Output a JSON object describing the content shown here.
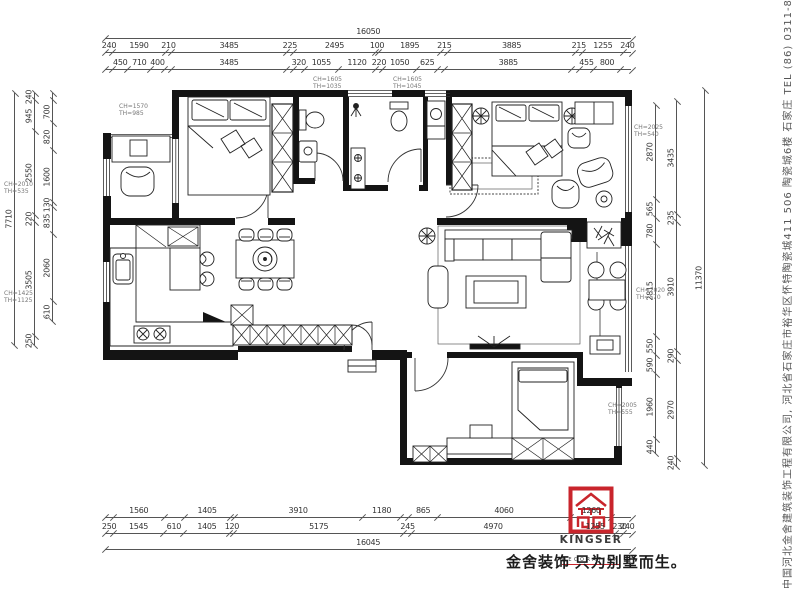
{
  "company_info": "中国河北金舍建筑装饰工程有限公司, 河北省石家庄市裕华区怀特陶瓷城411 506 陶瓷城6楼  石家庄  TEL (86) 0311-88995555",
  "slogan": "金舍装饰 只为别墅而生。",
  "logo": {
    "name": "KINGSER",
    "subtitle": "DECORATION",
    "accent_color": "#c9252c"
  },
  "dimensions": {
    "top_total": [
      {
        "v": 16050,
        "l": "16050"
      }
    ],
    "top_row2": [
      {
        "v": 240,
        "l": "240"
      },
      {
        "v": 1590,
        "l": "1590"
      },
      {
        "v": 210,
        "l": "210"
      },
      {
        "v": 3485,
        "l": "3485"
      },
      {
        "v": 225,
        "l": "225"
      },
      {
        "v": 2495,
        "l": "2495"
      },
      {
        "v": 100,
        "l": "100"
      },
      {
        "v": 1895,
        "l": "1895"
      },
      {
        "v": 215,
        "l": "215"
      },
      {
        "v": 3885,
        "l": "3885"
      },
      {
        "v": 215,
        "l": "215"
      },
      {
        "v": 1255,
        "l": "1255"
      },
      {
        "v": 240,
        "l": "240"
      }
    ],
    "top_row3": [
      {
        "v": 240,
        "l": ""
      },
      {
        "v": 450,
        "l": "450"
      },
      {
        "v": 710,
        "l": "710"
      },
      {
        "v": 400,
        "l": "400"
      },
      {
        "v": 240,
        "l": ""
      },
      {
        "v": 3485,
        "l": "3485"
      },
      {
        "v": 225,
        "l": ""
      },
      {
        "v": 320,
        "l": "320"
      },
      {
        "v": 1055,
        "l": "1055"
      },
      {
        "v": 1120,
        "l": "1120"
      },
      {
        "v": 220,
        "l": "220"
      },
      {
        "v": 1050,
        "l": "1050"
      },
      {
        "v": 625,
        "l": "625"
      },
      {
        "v": 215,
        "l": ""
      },
      {
        "v": 3885,
        "l": "3885"
      },
      {
        "v": 215,
        "l": ""
      },
      {
        "v": 455,
        "l": "455"
      },
      {
        "v": 800,
        "l": "800"
      },
      {
        "v": 340,
        "l": ""
      }
    ],
    "bottom_row1": [
      {
        "v": 250,
        "l": ""
      },
      {
        "v": 1560,
        "l": "1560"
      },
      {
        "v": 600,
        "l": ""
      },
      {
        "v": 1405,
        "l": "1405"
      },
      {
        "v": 120,
        "l": ""
      },
      {
        "v": 3910,
        "l": "3910"
      },
      {
        "v": 1180,
        "l": "1180"
      },
      {
        "v": 245,
        "l": ""
      },
      {
        "v": 865,
        "l": "865"
      },
      {
        "v": 4060,
        "l": "4060"
      },
      {
        "v": 1260,
        "l": "1260"
      },
      {
        "v": 590,
        "l": ""
      }
    ],
    "bottom_row2": [
      {
        "v": 250,
        "l": "250"
      },
      {
        "v": 1545,
        "l": "1545"
      },
      {
        "v": 610,
        "l": "610"
      },
      {
        "v": 1405,
        "l": "1405"
      },
      {
        "v": 120,
        "l": "120"
      },
      {
        "v": 5175,
        "l": "5175"
      },
      {
        "v": 245,
        "l": "245"
      },
      {
        "v": 4970,
        "l": "4970"
      },
      {
        "v": 1255,
        "l": "1255"
      },
      {
        "v": 230,
        "l": "230"
      },
      {
        "v": 240,
        "l": "240"
      }
    ],
    "bottom_total": [
      {
        "v": 16045,
        "l": "16045"
      }
    ],
    "left_total": [
      {
        "v": 7710,
        "l": "7710"
      }
    ],
    "left_mid": [
      {
        "v": 240,
        "l": "240"
      },
      {
        "v": 945,
        "l": "945"
      },
      {
        "v": 2550,
        "l": "2550"
      },
      {
        "v": 220,
        "l": "220"
      },
      {
        "v": 3505,
        "l": "3505"
      },
      {
        "v": 250,
        "l": "250"
      }
    ],
    "left_inner": [
      {
        "v": 240,
        "l": ""
      },
      {
        "v": 700,
        "l": "700"
      },
      {
        "v": 820,
        "l": "820"
      },
      {
        "v": 1600,
        "l": "1600"
      },
      {
        "v": 130,
        "l": "130"
      },
      {
        "v": 835,
        "l": "835"
      },
      {
        "v": 2060,
        "l": "2060"
      },
      {
        "v": 610,
        "l": "610"
      }
    ],
    "right_inner": [
      {
        "v": 2870,
        "l": "2870"
      },
      {
        "v": 565,
        "l": "565"
      },
      {
        "v": 780,
        "l": "780"
      },
      {
        "v": 2815,
        "l": "2815"
      },
      {
        "v": 550,
        "l": "550"
      },
      {
        "v": 590,
        "l": "590"
      },
      {
        "v": 1960,
        "l": "1960"
      },
      {
        "v": 440,
        "l": "440"
      }
    ],
    "right_mid": [
      {
        "v": 3435,
        "l": "3435"
      },
      {
        "v": 235,
        "l": "235"
      },
      {
        "v": 3910,
        "l": "3910"
      },
      {
        "v": 290,
        "l": "290"
      },
      {
        "v": 2970,
        "l": "2970"
      },
      {
        "v": 240,
        "l": "240"
      }
    ],
    "right_total": [
      {
        "v": 11370,
        "l": "11370"
      }
    ]
  },
  "room_labels": [
    {
      "l1": "CH=1570",
      "l2": "TH=985",
      "x": 119,
      "y": 103
    },
    {
      "l1": "CH=2010",
      "l2": "TH=535",
      "x": 4,
      "y": 181
    },
    {
      "l1": "CH=1425",
      "l2": "TH=1125",
      "x": 4,
      "y": 290
    },
    {
      "l1": "CH=1605",
      "l2": "TH=1035",
      "x": 313,
      "y": 76
    },
    {
      "l1": "CH=1605",
      "l2": "TH=1045",
      "x": 393,
      "y": 76
    },
    {
      "l1": "CH=2025",
      "l2": "TH=540",
      "x": 634,
      "y": 124
    },
    {
      "l1": "CH=2020",
      "l2": "TH=570",
      "x": 636,
      "y": 287
    },
    {
      "l1": "CH=2005",
      "l2": "TH=555",
      "x": 608,
      "y": 402
    }
  ]
}
